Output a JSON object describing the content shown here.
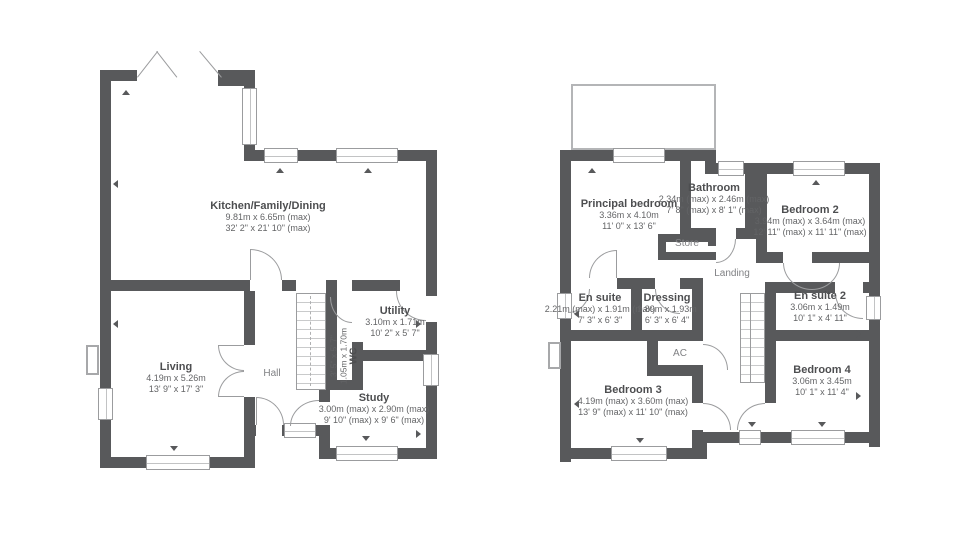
{
  "ground_floor": {
    "kitchen": {
      "name": "Kitchen/Family/Dining",
      "metric": "9.81m x 6.65m (max)",
      "imperial": "32' 2\" x 21' 10\" (max)"
    },
    "living": {
      "name": "Living",
      "metric": "4.19m x 5.26m",
      "imperial": "13' 9\" x 17' 3\""
    },
    "hall": {
      "name": "Hall"
    },
    "wc": {
      "name": "WC",
      "metric": "1.05m x 1.70m",
      "imperial": "3' 5\" x 5' 7\""
    },
    "utility": {
      "name": "Utility",
      "metric": "3.10m x 1.71m",
      "imperial": "10' 2\" x 5' 7\""
    },
    "study": {
      "name": "Study",
      "metric": "3.00m (max) x 2.90m (max)",
      "imperial": "9' 10\" (max) x 9' 6\" (max)"
    }
  },
  "first_floor": {
    "principal_bedroom": {
      "name": "Principal bedroom",
      "metric": "3.36m x 4.10m",
      "imperial": "11' 0\" x 13' 6\""
    },
    "bathroom": {
      "name": "Bathroom",
      "metric": "2.34m (max) x 2.46m (max)",
      "imperial": "7' 8\" (max) x 8' 1\" (max)"
    },
    "bedroom_2": {
      "name": "Bedroom 2",
      "metric": "3.94m (max) x 3.64m (max)",
      "imperial": "12' 11\" (max) x 11' 11\" (max)"
    },
    "store": {
      "name": "Store"
    },
    "landing": {
      "name": "Landing"
    },
    "en_suite": {
      "name": "En suite",
      "metric": "2.21m (max) x 1.91m (max)",
      "imperial": "7' 3\" x 6' 3\""
    },
    "dressing": {
      "name": "Dressing",
      "metric": "1.89m x 1.93m",
      "imperial": "6' 3\" x 6' 4\""
    },
    "en_suite_2": {
      "name": "En suite 2",
      "metric": "3.06m x 1.49m",
      "imperial": "10' 1\" x 4' 11\""
    },
    "ac": {
      "name": "AC"
    },
    "bedroom_3": {
      "name": "Bedroom 3",
      "metric": "4.19m (max) x 3.60m (max)",
      "imperial": "13' 9\" (max) x 11' 10\" (max)"
    },
    "bedroom_4": {
      "name": "Bedroom 4",
      "metric": "3.06m x 3.45m",
      "imperial": "10' 1\" x 11' 4\""
    }
  },
  "colors": {
    "wall": "#58595b",
    "window_frame": "#9b9c9e",
    "text": "#4d4e50"
  }
}
